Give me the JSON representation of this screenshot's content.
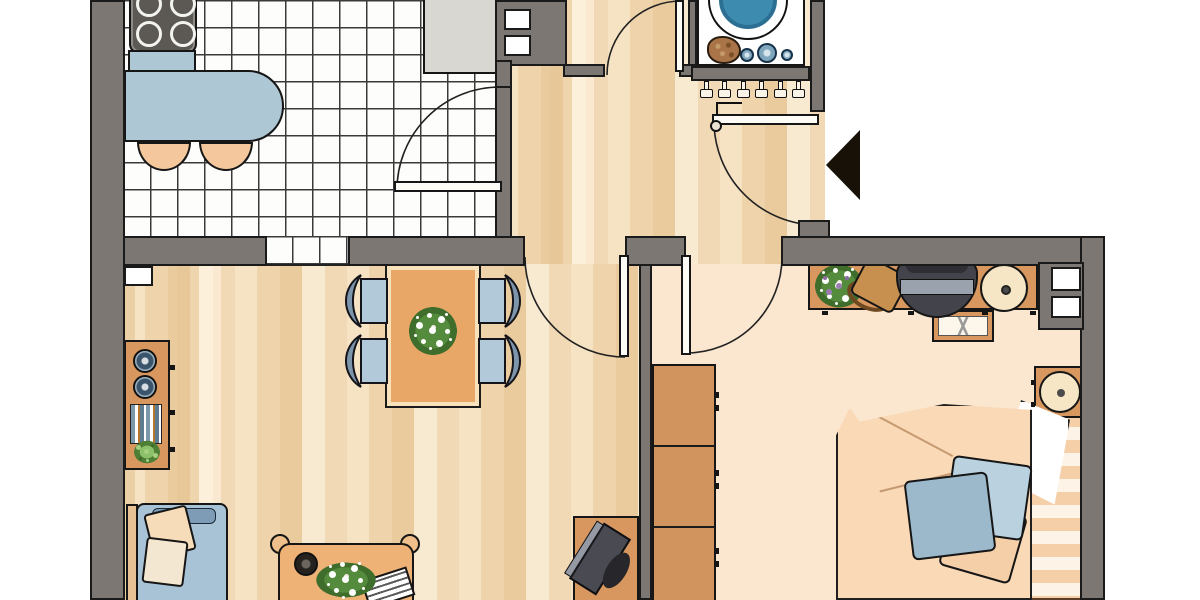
{
  "title": "Apartment floor plan (top-down architectural drawing)",
  "palette": {
    "wall": "#7d7773",
    "outline": "#1a1a1a",
    "tile_line": "#3a3a3a",
    "parquet_base": "#f3dcba",
    "carpet": "#fbe6cf",
    "wood": "#d7975f",
    "wood_light": "#eeb277",
    "table": "#e9a767",
    "table_trim": "#f8e2bb",
    "seat": "#b2c9da",
    "seat_back": "#7d95aa",
    "counter": "#adc7d4",
    "counter_gray": "#d9d7d2",
    "stool": "#f4c89c",
    "stove": "#5c5955",
    "washer_blue": "#3d8cb0",
    "knob": "#7fa6bd",
    "basket": "#a97448",
    "sofa": "#a9c3d6",
    "sofa_back": "#7e9cb5",
    "pillow_cream": "#f4e7d2",
    "pillow_peach": "#f7dcb9",
    "duvet": "#f9d9b6",
    "bed_stripe": "#f5cfa8",
    "pillow_blue_light": "#bad1e0",
    "pillow_blue": "#9cb9cc",
    "tv": "#4a4b52",
    "lamp": "#f6e6c6",
    "arrow": "#171107"
  },
  "rooms": {
    "kitchen": {
      "label": "Kitchen — tiled floor, stove, sink counter, breakfast bar with 2 stools"
    },
    "bathroom": {
      "label": "Bathroom — small tiles, door swinging in"
    },
    "laundry": {
      "label": "Laundry niche — washing machine, laundry basket, coat hooks"
    },
    "hallway": {
      "label": "Hallway — parquet, entrance door with arrow marker"
    },
    "living": {
      "label": "Living room — dining table with flowers, 4 chairs, sideboard, sofa, coffee table, TV"
    },
    "bedroom": {
      "label": "Bedroom — carpet, double bed, wardrobe, desk, nightstand"
    }
  },
  "furniture": {
    "kitchen": [
      "stove-cooktop",
      "breakfast-counter",
      "stool",
      "stool",
      "sink-counter",
      "wall-shaft"
    ],
    "laundry": [
      "washing-machine",
      "laundry-basket",
      "control-knobs",
      "coat-hooks"
    ],
    "living": [
      "radiator",
      "dining-table",
      "flower-bouquet",
      "dining-chair x4",
      "sideboard",
      "speakers",
      "books",
      "plant",
      "sofa",
      "pillows",
      "coffee-table",
      "magazine",
      "tv-stand",
      "tv"
    ],
    "bedroom": [
      "wardrobe",
      "desk",
      "flower-bouquet",
      "bag",
      "office-chair",
      "desk-lamp",
      "side-chair",
      "nightstand",
      "bedside-lamp",
      "double-bed",
      "duvet",
      "pillows",
      "wall-shaft"
    ]
  },
  "markers": {
    "entrance_arrow": "entrance direction arrow (points left at apartment door)"
  }
}
